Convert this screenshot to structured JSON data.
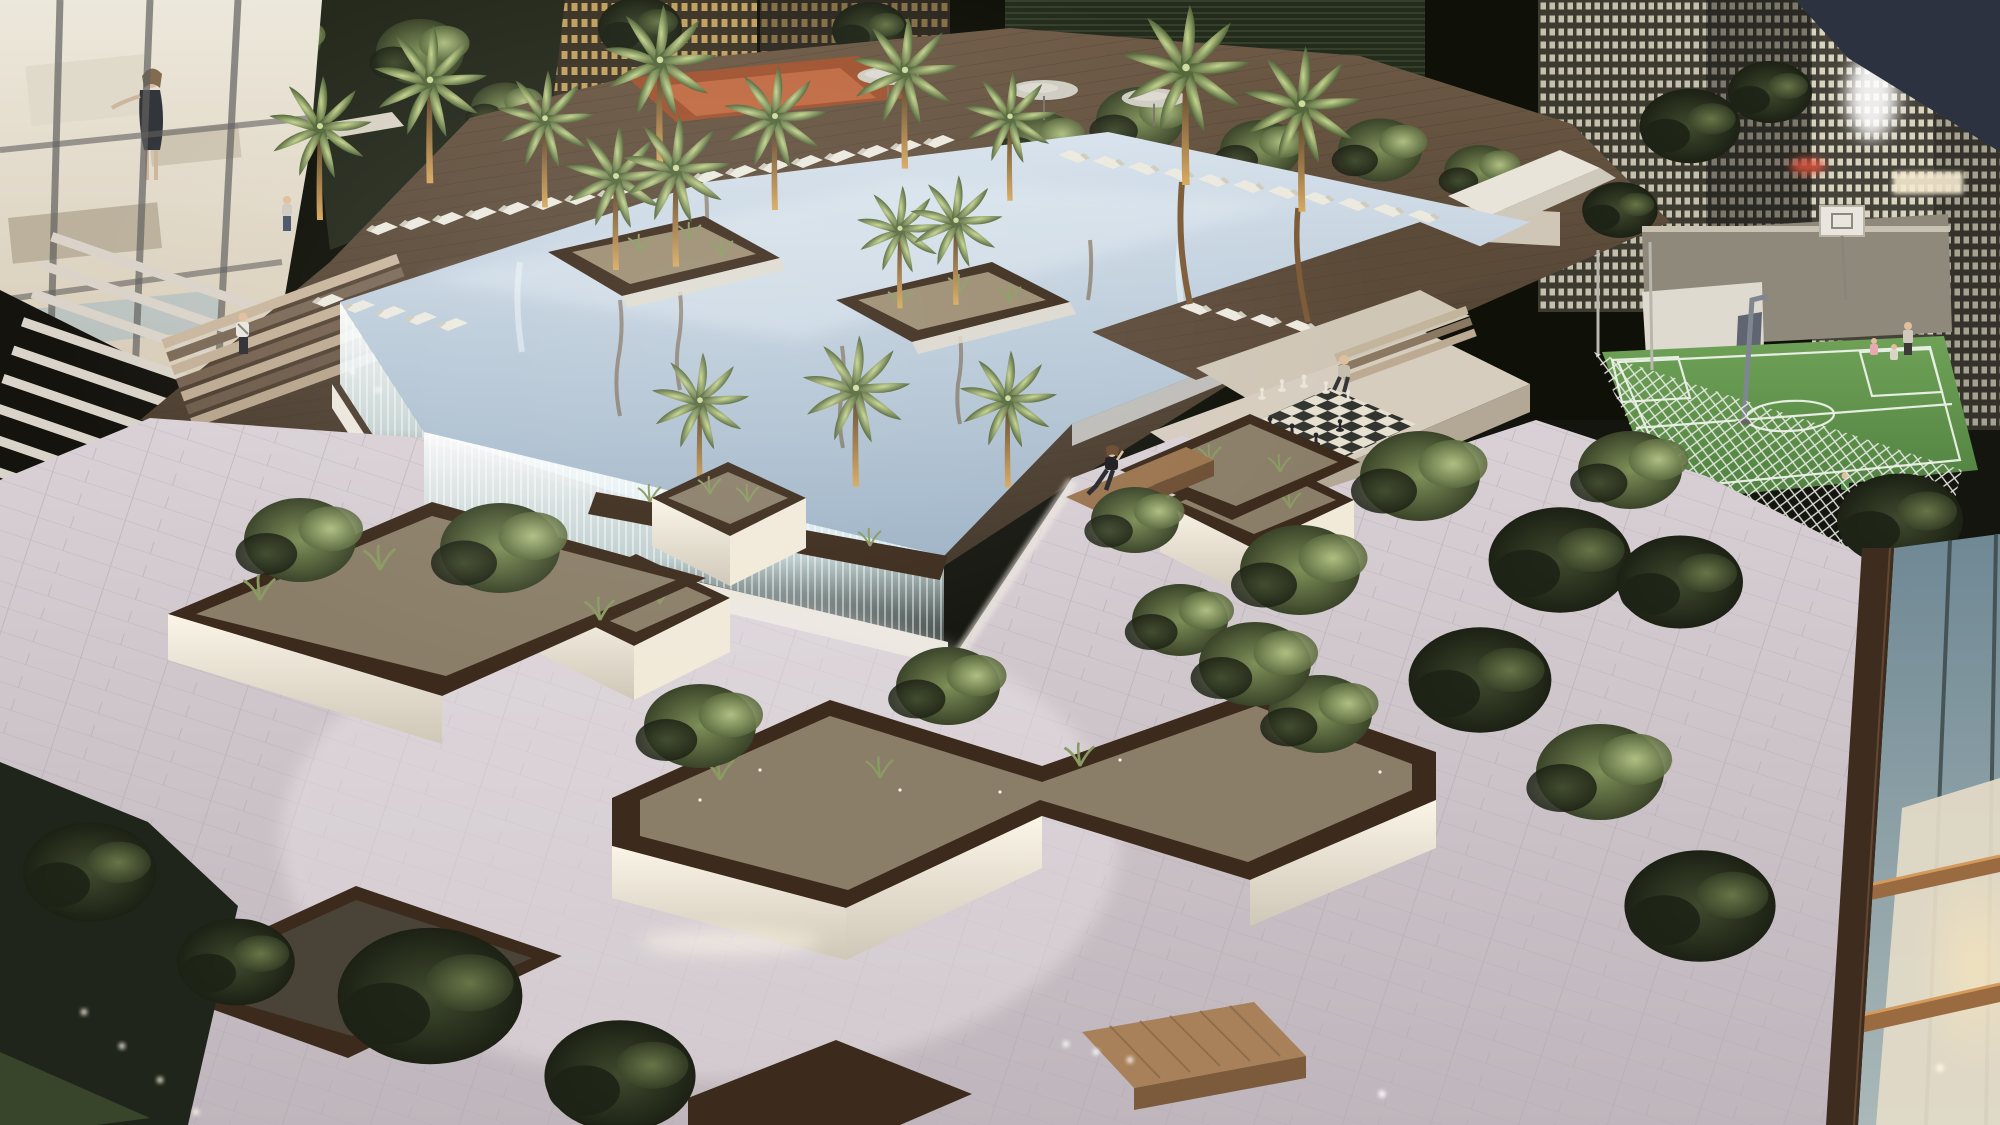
{
  "meta": {
    "type": "architectural-night-rendering",
    "view": "aerial three-quarter view at dusk",
    "subject": "rooftop amenity podium deck of a high-rise residential development"
  },
  "scene": {
    "setting": "landscaped rooftop terrace at night surrounded by illuminated city skyscrapers",
    "amenities": [
      "infinity-edge reflecting pool with glowing cascade waterfall walls",
      "palm trees in raised island planters with golden uplighting",
      "rows of white sun loungers on timber pool decks",
      "grey shade umbrellas",
      "terracotta pergola daybed",
      "giant outdoor chess set on checkered pad",
      "mini football and basketball court with white lattice fence and backboard",
      "angular bronze-rimmed planters with olive trees and ornamental grasses",
      "timber block benches",
      "pale plank-paved plaza with inset strip and spot lighting",
      "glass-walled lounge pavilion with warm interior",
      "tower facade of white horizontal louvers",
      "foreground residential tower with bronze mullions and glass balconies",
      "timber terrace steps"
    ],
    "figures": [
      "woman in black dress inside the glass pavilion",
      "person strolling on the upper garden terrace",
      "person in white shirt standing beside the pool steps",
      "woman in black sitting on a timber bench",
      "person seated beside the giant chess set",
      "adult with two children on the sports court",
      "child playing behind the court fence"
    ],
    "counts": {
      "sun_loungers": 39,
      "palm_trees": 14,
      "umbrellas": 3,
      "benches": 2,
      "chess_pieces_visible": 11
    }
  },
  "palette": {
    "night_sky": "#0f1109",
    "city_warm_window": "#d9b36a",
    "city_bright_window": "#f2ecd6",
    "pool_water_light": "#d7e2ec",
    "pool_water_deep": "#9eb3c6",
    "cascade_white": "#ffffff",
    "deck_wood": "#6e5a46",
    "deck_wood_dark": "#413528",
    "paving_light": "#d9d1d6",
    "paving_shadow": "#bfb5bc",
    "planter_rim_bronze": "#3c2b1c",
    "planter_soil": "#8a7e68",
    "planter_base_glow": "#f1ead9",
    "foliage_light": "#b9c98a",
    "foliage_mid": "#7f9058",
    "foliage_dark": "#3f4a2e",
    "trunk_lit": "#d8a95f",
    "court_green": "#4f8040",
    "court_green_light": "#6fa257",
    "court_line": "#f2f5ee",
    "fence_white": "#eeeeea",
    "wall_beige": "#d6cdbf",
    "bench_wood": "#9a744e",
    "bronze_frame": "#3e2c1f",
    "glass_teal": "#6f8894",
    "pergola_terracotta": "#a0522f",
    "lounger_white": "#eceadf",
    "umbrella_grey": "#cfccc2",
    "skin": "#e0bf9d",
    "figure_dark": "#1c1c20"
  }
}
